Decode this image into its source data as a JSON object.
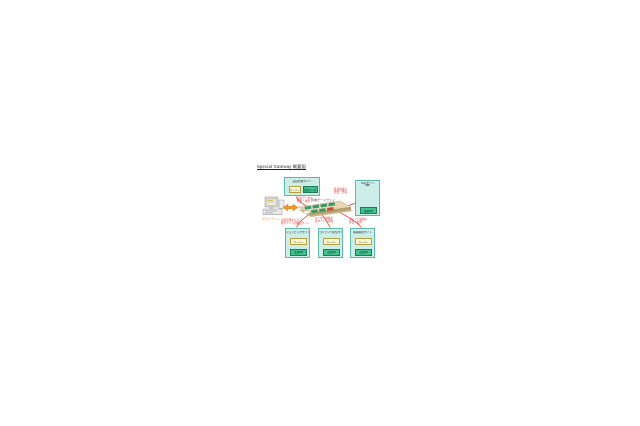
{
  "title": "Special Gateway 概要図",
  "client": {
    "label": "クライアント"
  },
  "gateway": {
    "label": "共通ゲートウェイ"
  },
  "top_box": {
    "title": "認証管理サイト",
    "server": "サーバー",
    "data": "認証データ"
  },
  "db_box": {
    "title": "SQLサーバ",
    "subtitle": "（DB）",
    "data": "顧客DB"
  },
  "bottom_boxes": [
    {
      "title": "ショッピングサイト",
      "server": "サーバー",
      "data": "会員DB"
    },
    {
      "title": "コンテンツ配信サイト",
      "server": "サーバー",
      "data": "会員DB"
    },
    {
      "title": "情報提供サイト",
      "server": "サーバー",
      "data": "会員DB"
    }
  ],
  "annotations": {
    "to_auth": "認証データの\n照会・更新",
    "to_db": "会員情報の\n照会・登録",
    "to_site1": "認証結果をもとに\n各サイトへ自動ログイン",
    "to_site2": "ユーザー情報を\n各サイトへ通知",
    "to_site3": "ポイント情報の\n照会・加算"
  },
  "colors": {
    "container_fill": "#cdeee8",
    "container_border": "#5fb9ab",
    "server_fill": "#fdf6d4",
    "server_border": "#b3a33f",
    "data_fill": "#3fc08d",
    "data_border": "#1f7a55",
    "annotation_red": "#e02a2a",
    "client_orange": "#e8820a",
    "platform_tan": "#e6d7b2",
    "module_green": "#2f9e68"
  }
}
